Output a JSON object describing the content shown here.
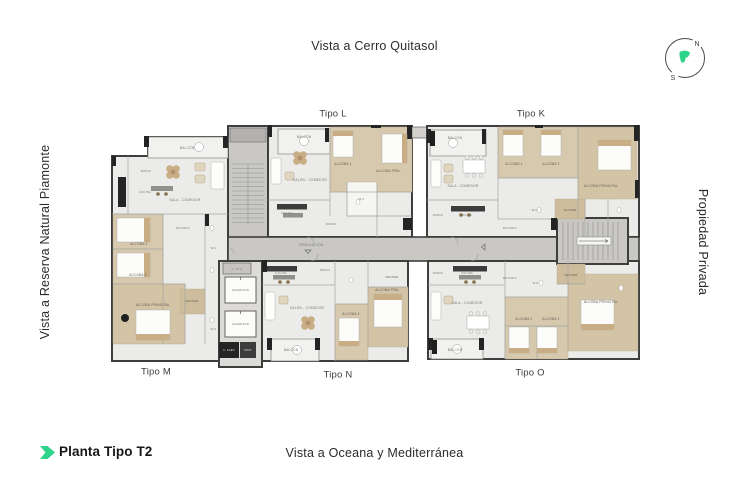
{
  "header": {
    "top_view_label": "Vista a Cerro Quitasol"
  },
  "side_labels": {
    "left": "Vista a Reserva Natural Piamonte",
    "right": "Propiedad Privada"
  },
  "footer": {
    "plan_title": "Planta Tipo T2",
    "bottom_view_label": "Vista a Oceana y Mediterránea"
  },
  "compass": {
    "north": "N",
    "south": "S"
  },
  "colors": {
    "accent_green": "#2ed489",
    "wall_dark": "#3a3a3a",
    "floor": "#ebebe9",
    "wood": "#d7c9ae",
    "concrete": "#c9c8c4"
  },
  "plan": {
    "unit_labels": {
      "l": "Tipo L",
      "k": "Tipo K",
      "m": "Tipo M",
      "n": "Tipo N",
      "o": "Tipo O"
    },
    "rooms": {
      "balcon": "BALCÓN",
      "sala_comedor": "SALA - COMEDOR",
      "salon_comedor": "SALÓN - COMEDOR",
      "cocina": "COCINA",
      "ropas": "ROPAS",
      "estudio": "ESTUDIO",
      "alcoba_1": "ALCOBA 1",
      "alcoba_2": "ALCOBA 2",
      "alcoba_ppal": "ALCOBA PPAL.",
      "alcoba_principal": "ALCOBA PRINCIPAL",
      "vestier": "VESTIER",
      "wc": "W.C.",
      "circulacion": "CIRCULACIÓN",
      "c_util": "C. ÚTIL",
      "ascensor": "ASCENSOR",
      "c_aseo": "C. ASEO",
      "shut": "SHUT"
    }
  }
}
